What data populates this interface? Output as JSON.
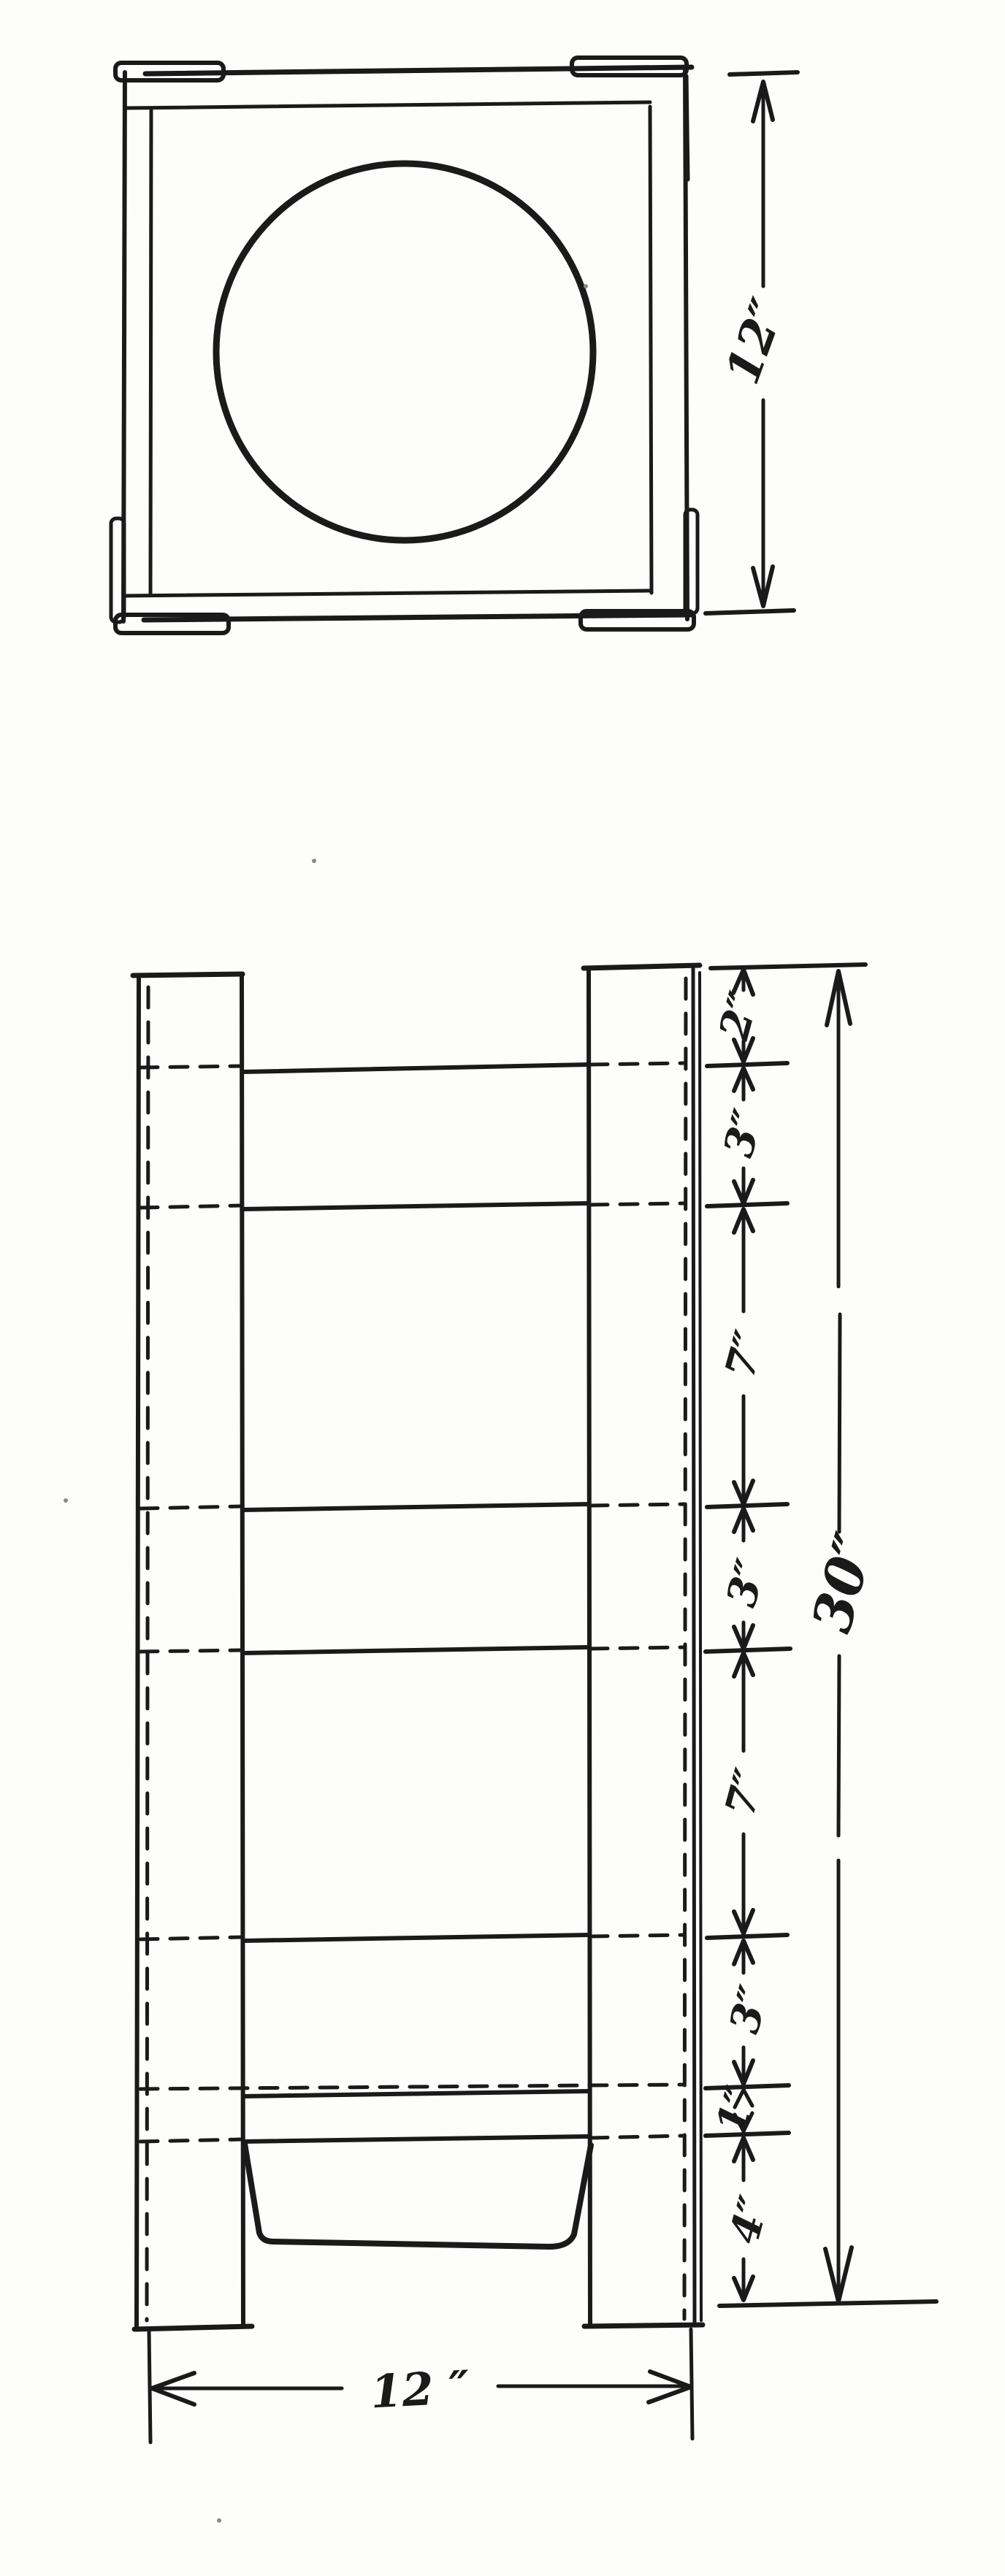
{
  "page": {
    "background": "#fdfdfc",
    "ink": "#1a1a1a"
  },
  "plan_view": {
    "height_dimension": {
      "label": "12″"
    }
  },
  "elevation_view": {
    "segment_dimensions": [
      {
        "label": "2″"
      },
      {
        "label": "3″"
      },
      {
        "label": "7″"
      },
      {
        "label": "3″"
      },
      {
        "label": "7″"
      },
      {
        "label": "3″"
      },
      {
        "label": "1″"
      },
      {
        "label": "4″"
      }
    ],
    "overall_height_dimension": {
      "label": "30″"
    },
    "overall_width_dimension": {
      "label": "12 ″"
    }
  }
}
